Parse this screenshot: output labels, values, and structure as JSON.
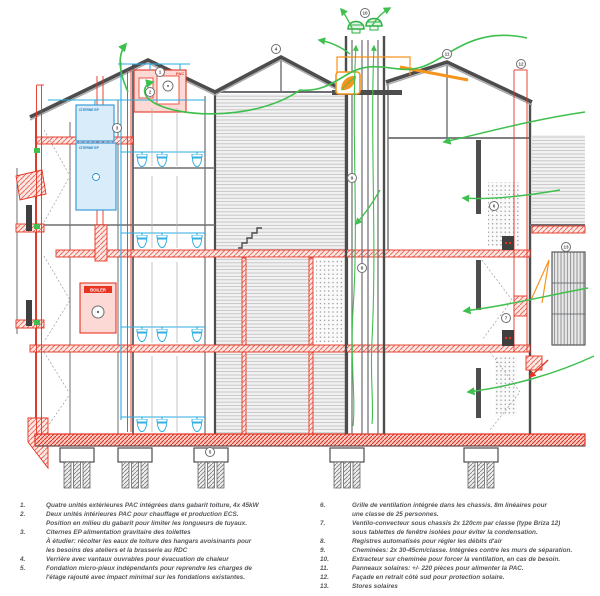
{
  "drawing": {
    "labels": {
      "pac": "PAC",
      "boiler": "BOILER",
      "citerne_top": "CITERNE EP",
      "citerne_bottom": "CITERNE EP"
    },
    "colors": {
      "red": "#e63322",
      "red_fill": "#fcd9d4",
      "blue": "#29abe2",
      "blue_fill": "#d9ecfa",
      "green": "#3fbf4e",
      "orange": "#f7941d",
      "wall_gray": "#4d4d4d"
    },
    "markers": [
      {
        "n": "1",
        "x": 160,
        "y": 72
      },
      {
        "n": "2",
        "x": 150,
        "y": 92
      },
      {
        "n": "3",
        "x": 117,
        "y": 128
      },
      {
        "n": "4",
        "x": 276,
        "y": 49
      },
      {
        "n": "5",
        "x": 210,
        "y": 452
      },
      {
        "n": "6",
        "x": 494,
        "y": 206
      },
      {
        "n": "7",
        "x": 506,
        "y": 318
      },
      {
        "n": "8",
        "x": 362,
        "y": 268
      },
      {
        "n": "9",
        "x": 352,
        "y": 178
      },
      {
        "n": "10",
        "x": 365,
        "y": 13
      },
      {
        "n": "11",
        "x": 447,
        "y": 54
      },
      {
        "n": "12",
        "x": 521,
        "y": 64
      },
      {
        "n": "13",
        "x": 566,
        "y": 247
      }
    ]
  },
  "legend": {
    "left": [
      {
        "num": "1.",
        "lines": [
          "Quatre unités extérieures PAC intégrées dans gabarit toiture, 4x 45kW"
        ]
      },
      {
        "num": "2.",
        "lines": [
          "Deux unités intérieures PAC pour chauffage et production ECS.",
          "Position en milieu du gabarit pour limiter les longueurs de tuyaux."
        ]
      },
      {
        "num": "3.",
        "lines": [
          "Citernes EP alimentation gravitaire des toilettes",
          "À étudier: récolter les eaux de toiture des hangars avoisinants pour",
          "les besoins des ateliers et la brasserie au RDC"
        ]
      },
      {
        "num": "4.",
        "lines": [
          "Verrière avec vantaux ouvrables pour évacuation de chaleur"
        ]
      },
      {
        "num": "5.",
        "lines": [
          "Fondation micro-pieux indépendants pour reprendre les charges de",
          "l'étage rajouté avec impact minimal sur les fondations existantes."
        ]
      }
    ],
    "right": [
      {
        "num": "6.",
        "lines": [
          "Grille de ventilation intégrée dans les chassis. 8m linéaires pour",
          "une classe de 25 personnes."
        ]
      },
      {
        "num": "7.",
        "lines": [
          "Ventilo-convecteur sous chassis 2x 120cm par classe (type Briza 12)",
          "sous tablettes de fenêtre isolées pour éviter la condensation."
        ]
      },
      {
        "num": "8.",
        "lines": [
          "Registres automatisés pour régler les débits d'air"
        ]
      },
      {
        "num": "9.",
        "lines": [
          "Cheminées: 2x 30-45cm/classe. Intégrées contre les murs de séparation."
        ]
      },
      {
        "num": "10.",
        "lines": [
          "Extracteur sur cheminée pour forcer la ventilation, en cas de besoin."
        ]
      },
      {
        "num": "11.",
        "lines": [
          "Panneaux solaires: +/- 220 pièces pour alimenter la PAC."
        ]
      },
      {
        "num": "12.",
        "lines": [
          "Façade en retrait côté sud pour protection solaire."
        ]
      },
      {
        "num": "13.",
        "lines": [
          "Stores solaires"
        ]
      }
    ]
  }
}
